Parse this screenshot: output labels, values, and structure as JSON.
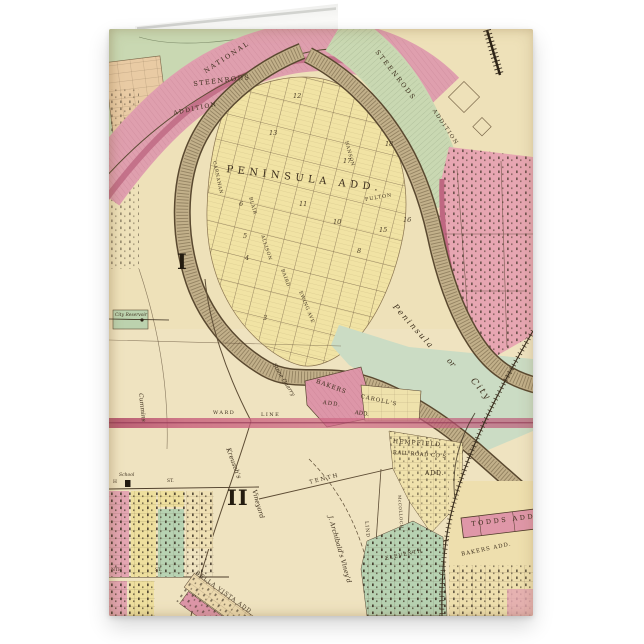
{
  "product": {
    "kind": "folded greeting card preview",
    "subject": "vintage plat map of upper Wheeling with Peninsula Addition"
  },
  "colors": {
    "page_background": "#ffffff",
    "parchment": "#eee1b9",
    "block_yellow": "#f1e3a4",
    "block_pink": "#df9fae",
    "block_green": "#c9d8b2",
    "creek": "#bcaa84",
    "ward_line_stripe": "#c05a7a",
    "ink": "#3e301e"
  },
  "labels": {
    "national": "NATIONAL",
    "steenrods_w1": "STEENRODS",
    "steenrods_w2": "ADDITION",
    "steenrods_e1": "STEENRODS",
    "steenrods_e2": "ADDITION",
    "peninsula_add": "PENINSULA ADD.",
    "carnahan": "CARNAHAN",
    "blair": "BLAIR",
    "allison": "ALLISON",
    "baird": "BAIRD",
    "ewing": "EWING AVE",
    "fulton": "FULTON",
    "hanson": "HANSON",
    "tenth": "TENTH",
    "eleventh": "ELEVENTH",
    "lind": "LIND",
    "mccolloch": "McCOLLOCH",
    "peninsula_it": "Peninsula",
    "or_it": "or",
    "city_it": "City",
    "ward1": "I",
    "ward2": "II",
    "reservoir": "City Reservoir",
    "cummins": "Cummins",
    "ward_w": "WARD",
    "line_w": "LINE",
    "stone_quarry": "Stone Quarry",
    "bakers1": "BAKERS",
    "bakers2": "ADD.",
    "carolls1": "CAROLL'S",
    "carolls2": "ADD.",
    "hemp1": "HEMPFIELD",
    "hemp2": "RAIL ROAD CO'S",
    "hemp3": "ADD.",
    "todds": "TODDS ADD.",
    "bakers_se": "BAKERS ADD.",
    "bella_vista": "BELLA VISTA ADD",
    "kreuschs": "Kreusch's",
    "vineyard": "Vineyard",
    "archibald": "J. Archibald's Viney'd",
    "school": "School",
    "st1h": "H",
    "st1": "ST.",
    "st2nth": "NTH",
    "st2": "ST.",
    "n18": "18",
    "n17": "17",
    "n16": "16",
    "n15": "15",
    "n13": "13",
    "n12": "12",
    "n11": "11",
    "n10": "10",
    "n8": "8",
    "n6": "6",
    "n5": "5",
    "n4": "4",
    "n3": "3"
  }
}
